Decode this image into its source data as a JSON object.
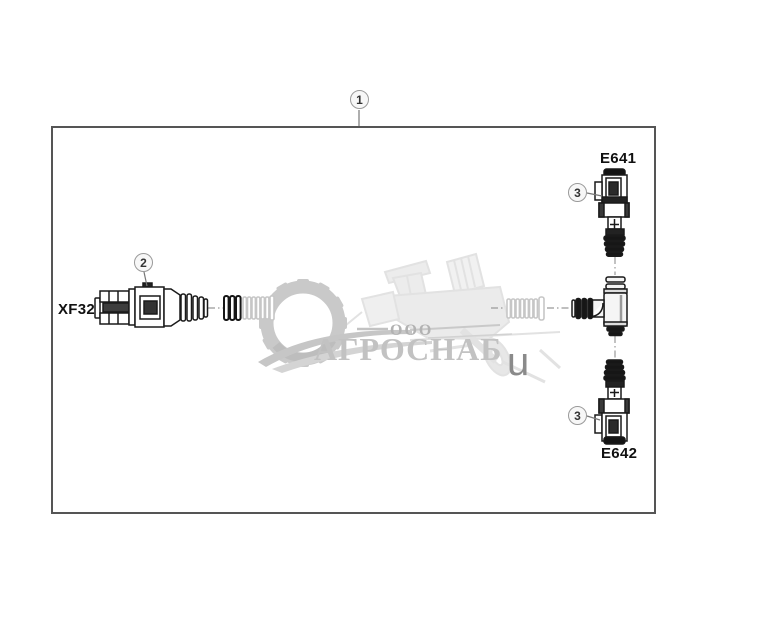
{
  "diagram": {
    "callouts": [
      {
        "id": "item-1",
        "number": "1"
      },
      {
        "id": "item-2",
        "number": "2"
      },
      {
        "id": "item-3-top",
        "number": "3"
      },
      {
        "id": "item-3-bottom",
        "number": "3"
      }
    ],
    "connector_labels": {
      "left": "XF32",
      "top_right": "E641",
      "bottom_right": "E642"
    }
  },
  "watermark": {
    "org_prefix": "ООО",
    "org_name": "АГРОСНАБ",
    "stray_letter": "u"
  },
  "colors": {
    "frame_border": "#555555",
    "part_line": "#1a1a1a",
    "part_dark_fill": "#161616",
    "dash_line": "#999999",
    "callout_leader": "#777777",
    "watermark_gear": "#c6c6c6",
    "watermark_machine": "#e2e2e2",
    "watermark_text": "#bdbdbd",
    "stray_letter_gray": "#8a8a8a"
  }
}
